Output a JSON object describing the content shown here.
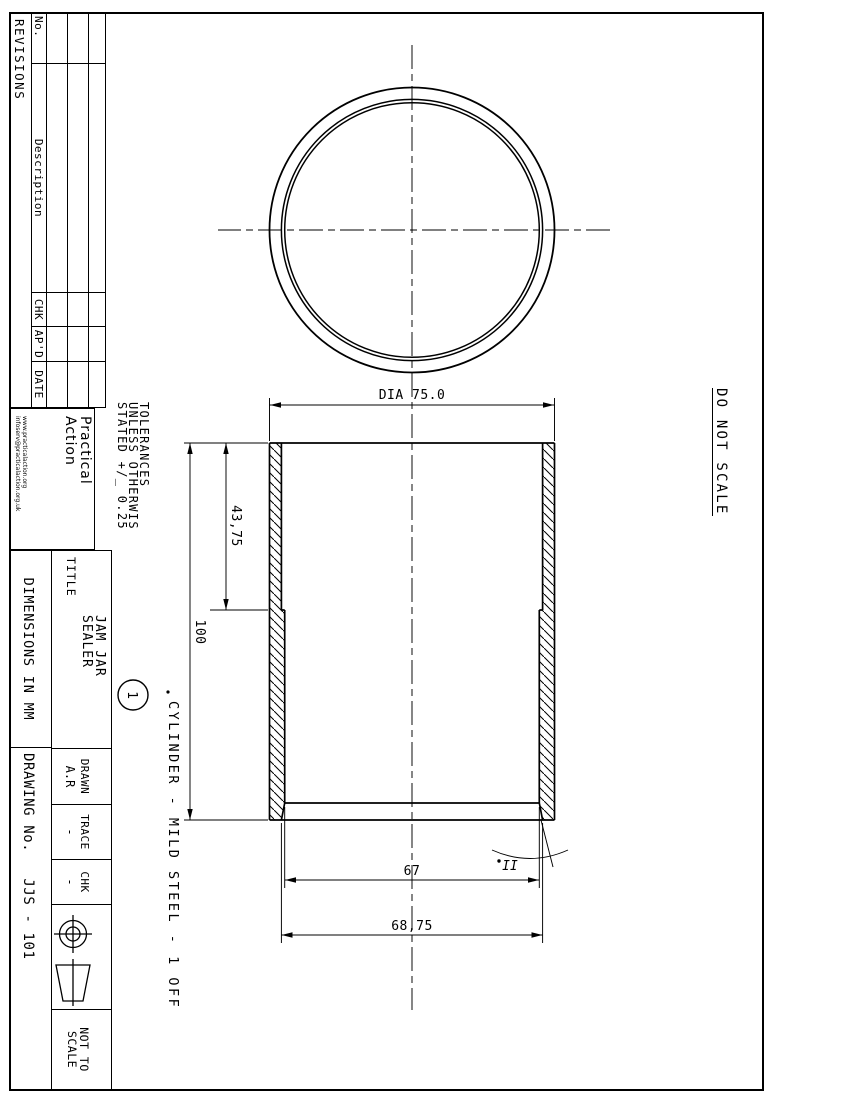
{
  "revisions": {
    "title": "REVISIONS",
    "headers": [
      "No.",
      "Description",
      "CHK",
      "AP'D",
      "DATE"
    ]
  },
  "logo": {
    "line1": "Practical",
    "line2": "Action",
    "web1": "www.practicalaction.org",
    "web2": "infoserv@practicalaction.org.uk"
  },
  "tolerances": {
    "line1": "TOLERANCES",
    "line2": "UNLESS OTHERWIS",
    "line3": "STATED +/_ 0.25"
  },
  "title_block": {
    "title_label": "TITLE",
    "title_line1": "JAM JAR",
    "title_line2": "SEALER",
    "dimensions_note": "DIMENSIONS IN MM",
    "drawn_label": "DRAWN",
    "drawn_value": "A.R",
    "trace_label": "TRACE",
    "trace_value": "-",
    "chk_label": "CHK",
    "chk_value": "-",
    "drawing_no_label": "DRAWING No.",
    "drawing_no_value": "JJS - 101",
    "scale_note_line1": "NOT TO",
    "scale_note_line2": "SCALE"
  },
  "notes": {
    "do_not_scale": "DO NOT SCALE",
    "balloon_number": "1",
    "part_note": "CYLINDER - MILD STEEL - 1 OFF",
    "detail_label": "II"
  },
  "dimensions": {
    "outer_diameter": "DIA 75.0",
    "step_length": "43,75",
    "total_length": "100",
    "bore_small": "67",
    "bore_large": "68,75"
  },
  "colors": {
    "line": "#000000",
    "paper": "#ffffff"
  }
}
